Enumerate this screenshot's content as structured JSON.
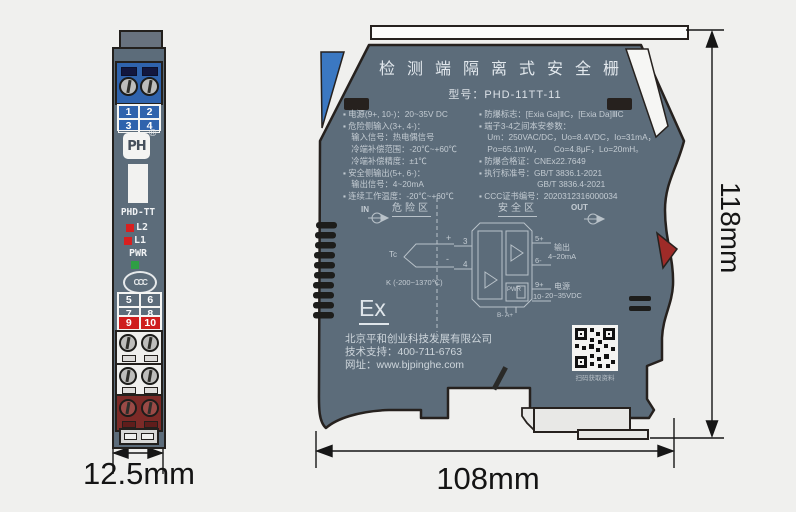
{
  "front_view": {
    "terminals_top": [
      "1",
      "2",
      "3",
      "4"
    ],
    "logo_text": "PH",
    "logo_reg": "®",
    "model_label": "PHD-TT",
    "led_l2": "L2",
    "led_l1": "L1",
    "led_pwr": "PWR",
    "ccc_mark": "CCC",
    "terminals_mid": [
      "5",
      "6",
      "7",
      "8"
    ],
    "terminals_red": [
      "9",
      "10"
    ]
  },
  "side_view": {
    "title": "检测端隔离式安全栅",
    "model_line": "型号：PHD-11TT-11",
    "specs_left": [
      "▪ 电源(9+, 10-)：20~35V DC",
      "▪ 危险侧输入(3+, 4-)：",
      "　输入信号：热电偶信号",
      "　冷端补偿范围：-20℃~+60℃",
      "　冷端补偿精度：±1℃",
      "▪ 安全侧输出(5+, 6-)：",
      "　输出信号：4~20mA",
      "▪ 连续工作温度：-20℃~+60℃"
    ],
    "specs_right": [
      "▪ 防爆标志：[Exia Ga]ⅡC，[Exia Da]ⅢC",
      "▪ 端子3-4之间本安参数：",
      "　Um：250VAC/DC，Uo=8.4VDC，Io=31mA，",
      "　Po=65.1mW，　　Co=4.8μF，Lo=20mH。",
      "▪ 防爆合格证：CNEx22.7649",
      "▪ 执行标准号：GB/T 3836.1-2021",
      "　　　　　　　GB/T 3836.4-2021",
      "▪ CCC证书编号：2020312316000034"
    ],
    "diagram": {
      "hazard_zone": "危险区",
      "safe_zone": "安全区",
      "in_label": "IN",
      "out_label": "OUT",
      "tc_label": "Tc",
      "plus": "+",
      "minus": "-",
      "tc_range": "K (-200~1370℃)",
      "t3": "3",
      "t4": "4",
      "t5": "5+",
      "t6": "6-",
      "t9": "9+",
      "t10": "10-",
      "pwr_label": "PWR",
      "bottom_terminals": "B-  A+",
      "out_title": "输出",
      "out_value": "4~20mA",
      "power_title": "电源",
      "power_value": "20~35VDC"
    },
    "ex_mark": "Ex",
    "company": "北京平和创业科技发展有限公司",
    "support": "技术支持：400-711-6763",
    "website": "网址：www.bjpinghe.com",
    "qr_caption": "扫码获取资料"
  },
  "dimensions": {
    "front_width": "12.5mm",
    "side_width": "108mm",
    "height": "118mm"
  },
  "colors": {
    "body": "#5c6c7a",
    "terminal_blue": "#2f63ad",
    "terminal_red": "#7c2a27",
    "highlight_red": "#cf1d1d",
    "led_red": "#d81f1f",
    "led_green": "#2f9e44",
    "clip_blue": "#3b78c2",
    "clip_red": "#9e2b28"
  }
}
